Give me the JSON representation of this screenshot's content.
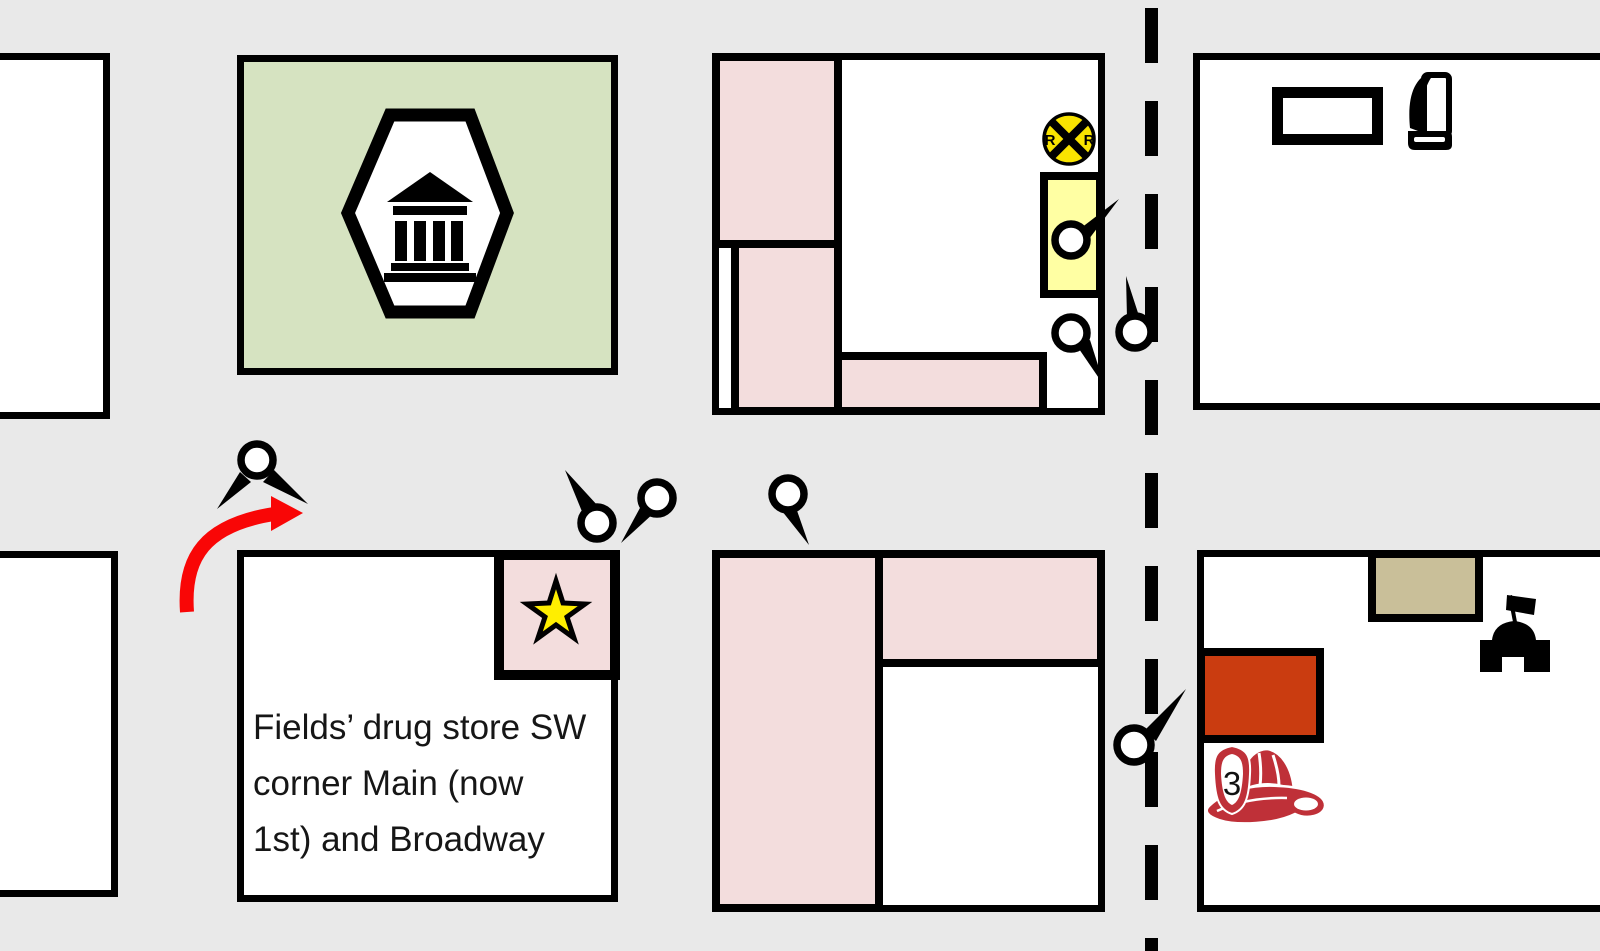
{
  "palette": {
    "road-gray": "#e9e9e9",
    "block-white": "#ffffff",
    "ink-black": "#000000",
    "building-pink": "#f3dddd",
    "block-green": "#d6e3c1",
    "highlight-yellow": "#ffffa3",
    "rr-sign-yellow": "#f9e400",
    "building-tan": "#c9bf99",
    "building-orange-red": "#ca3c10",
    "helmet-red": "#bf3038",
    "arrow-red": "#f90606",
    "star-yellow": "#ffee00"
  },
  "annotation": {
    "line1": "Fields’ drug store SW",
    "line2": "corner Main (now",
    "line3": "1st) and Broadway"
  },
  "rr_sign": {
    "left_letter": "R",
    "right_letter": "R"
  },
  "fire_helmet": {
    "number": "3"
  },
  "icons": {
    "bank": "bank-building-icon",
    "railroad": "railroad-crossing-icon",
    "map_pin": "map-pin-icon",
    "star": "star-icon",
    "book": "book-icon",
    "fort": "fort-flag-icon",
    "fire_helmet": "fire-helmet-icon",
    "curved_arrow": "curved-arrow-icon",
    "dashed_centerline": "dashed-road-centerline"
  }
}
